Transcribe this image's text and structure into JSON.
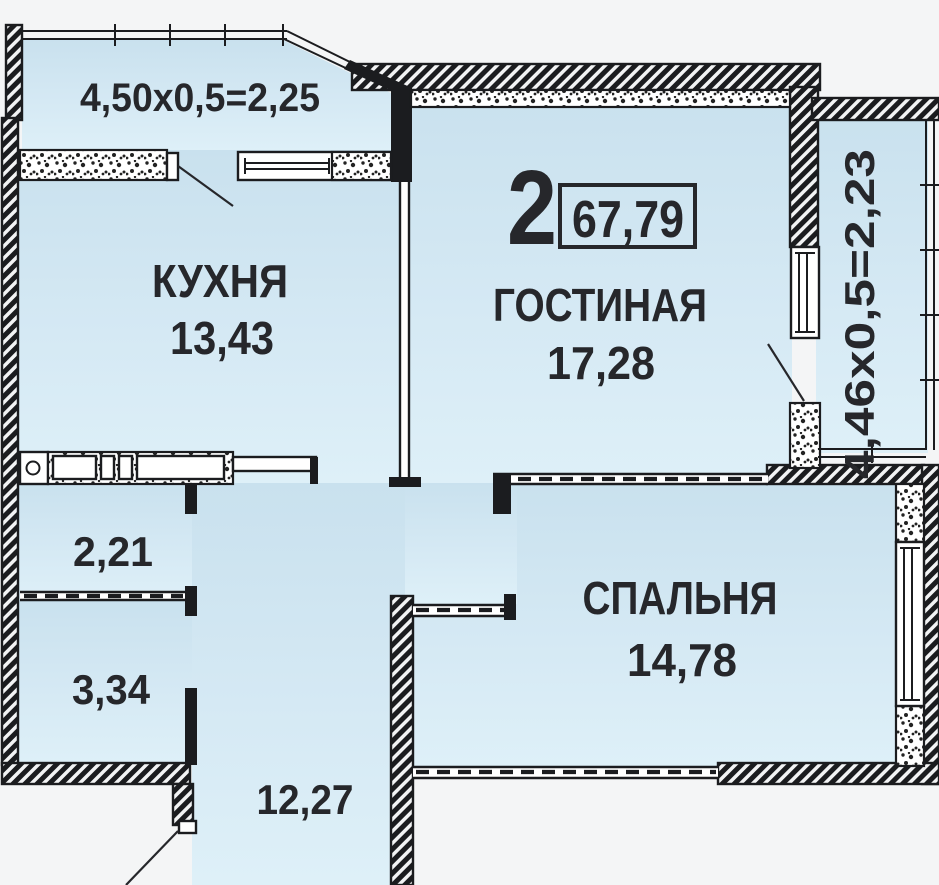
{
  "summary": {
    "rooms_count": "2",
    "total_area": "67,79"
  },
  "rooms": {
    "balcony_top": {
      "dimensions": "4,50x0,5=2,25"
    },
    "balcony_right": {
      "dimensions": "4,46x0,5=2,23"
    },
    "kitchen": {
      "name": "КУХНЯ",
      "area": "13,43"
    },
    "living_room": {
      "name": "ГОСТИНАЯ",
      "area": "17,28"
    },
    "bedroom": {
      "name": "СПАЛЬНЯ",
      "area": "14,78"
    },
    "hallway": {
      "area": "2,21"
    },
    "bathroom": {
      "area": "3,34"
    },
    "corridor": {
      "area": "12,27"
    }
  },
  "colors": {
    "room_fill_top": "#c9e1ee",
    "room_fill_bottom": "#def0f8",
    "wall": "#1b1c1f",
    "text": "#26272b",
    "background": "#f4f5f6"
  }
}
